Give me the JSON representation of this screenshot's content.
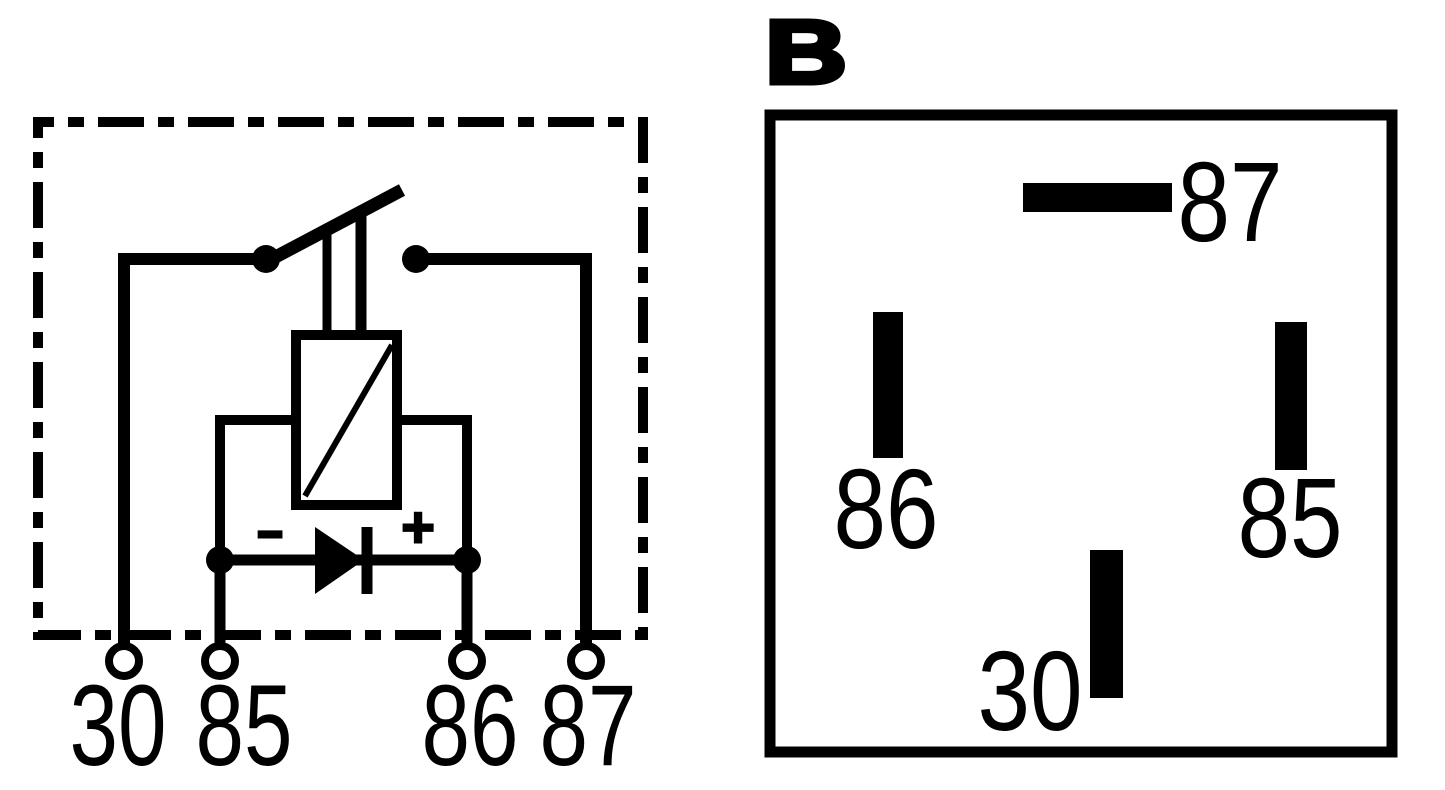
{
  "colors": {
    "ink": "#000000",
    "background": "#ffffff"
  },
  "left_schematic": {
    "coil_polarity": {
      "minus": "−",
      "plus": "+"
    },
    "terminals": [
      {
        "label": "30"
      },
      {
        "label": "85"
      },
      {
        "label": "86"
      },
      {
        "label": "87"
      }
    ]
  },
  "right_pinout": {
    "title": "B",
    "pins": [
      {
        "label": "87"
      },
      {
        "label": "86"
      },
      {
        "label": "85"
      },
      {
        "label": "30"
      }
    ]
  }
}
